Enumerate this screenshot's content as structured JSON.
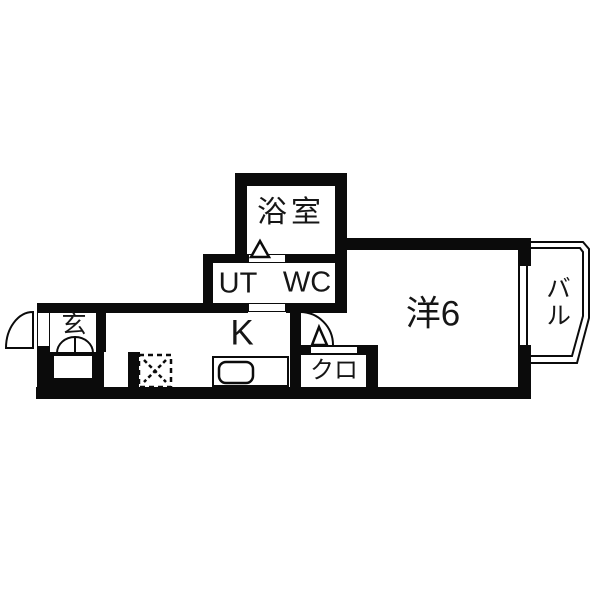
{
  "floorplan": {
    "type": "japanese-apartment-1k",
    "colors": {
      "wall": "#0b0b0b",
      "floor": "#ffffff",
      "text": "#161616"
    },
    "rooms": {
      "bathroom": {
        "label": "浴室"
      },
      "utility": {
        "label": "UT"
      },
      "toilet": {
        "label": "WC"
      },
      "entrance": {
        "label": "玄"
      },
      "kitchen": {
        "label": "K"
      },
      "closet": {
        "label": "クロ"
      },
      "western_room": {
        "label": "洋6"
      },
      "balcony": {
        "label": "バル"
      }
    },
    "fixtures": [
      "entrance-door-swing-arc",
      "entrance-double-door",
      "shoe-cabinet",
      "refrigerator-space",
      "washer-space-dashed",
      "kitchen-sink-counter",
      "bathroom-door-triangle",
      "room-door-swing-arc",
      "balcony-outline",
      "window-to-balcony"
    ]
  }
}
